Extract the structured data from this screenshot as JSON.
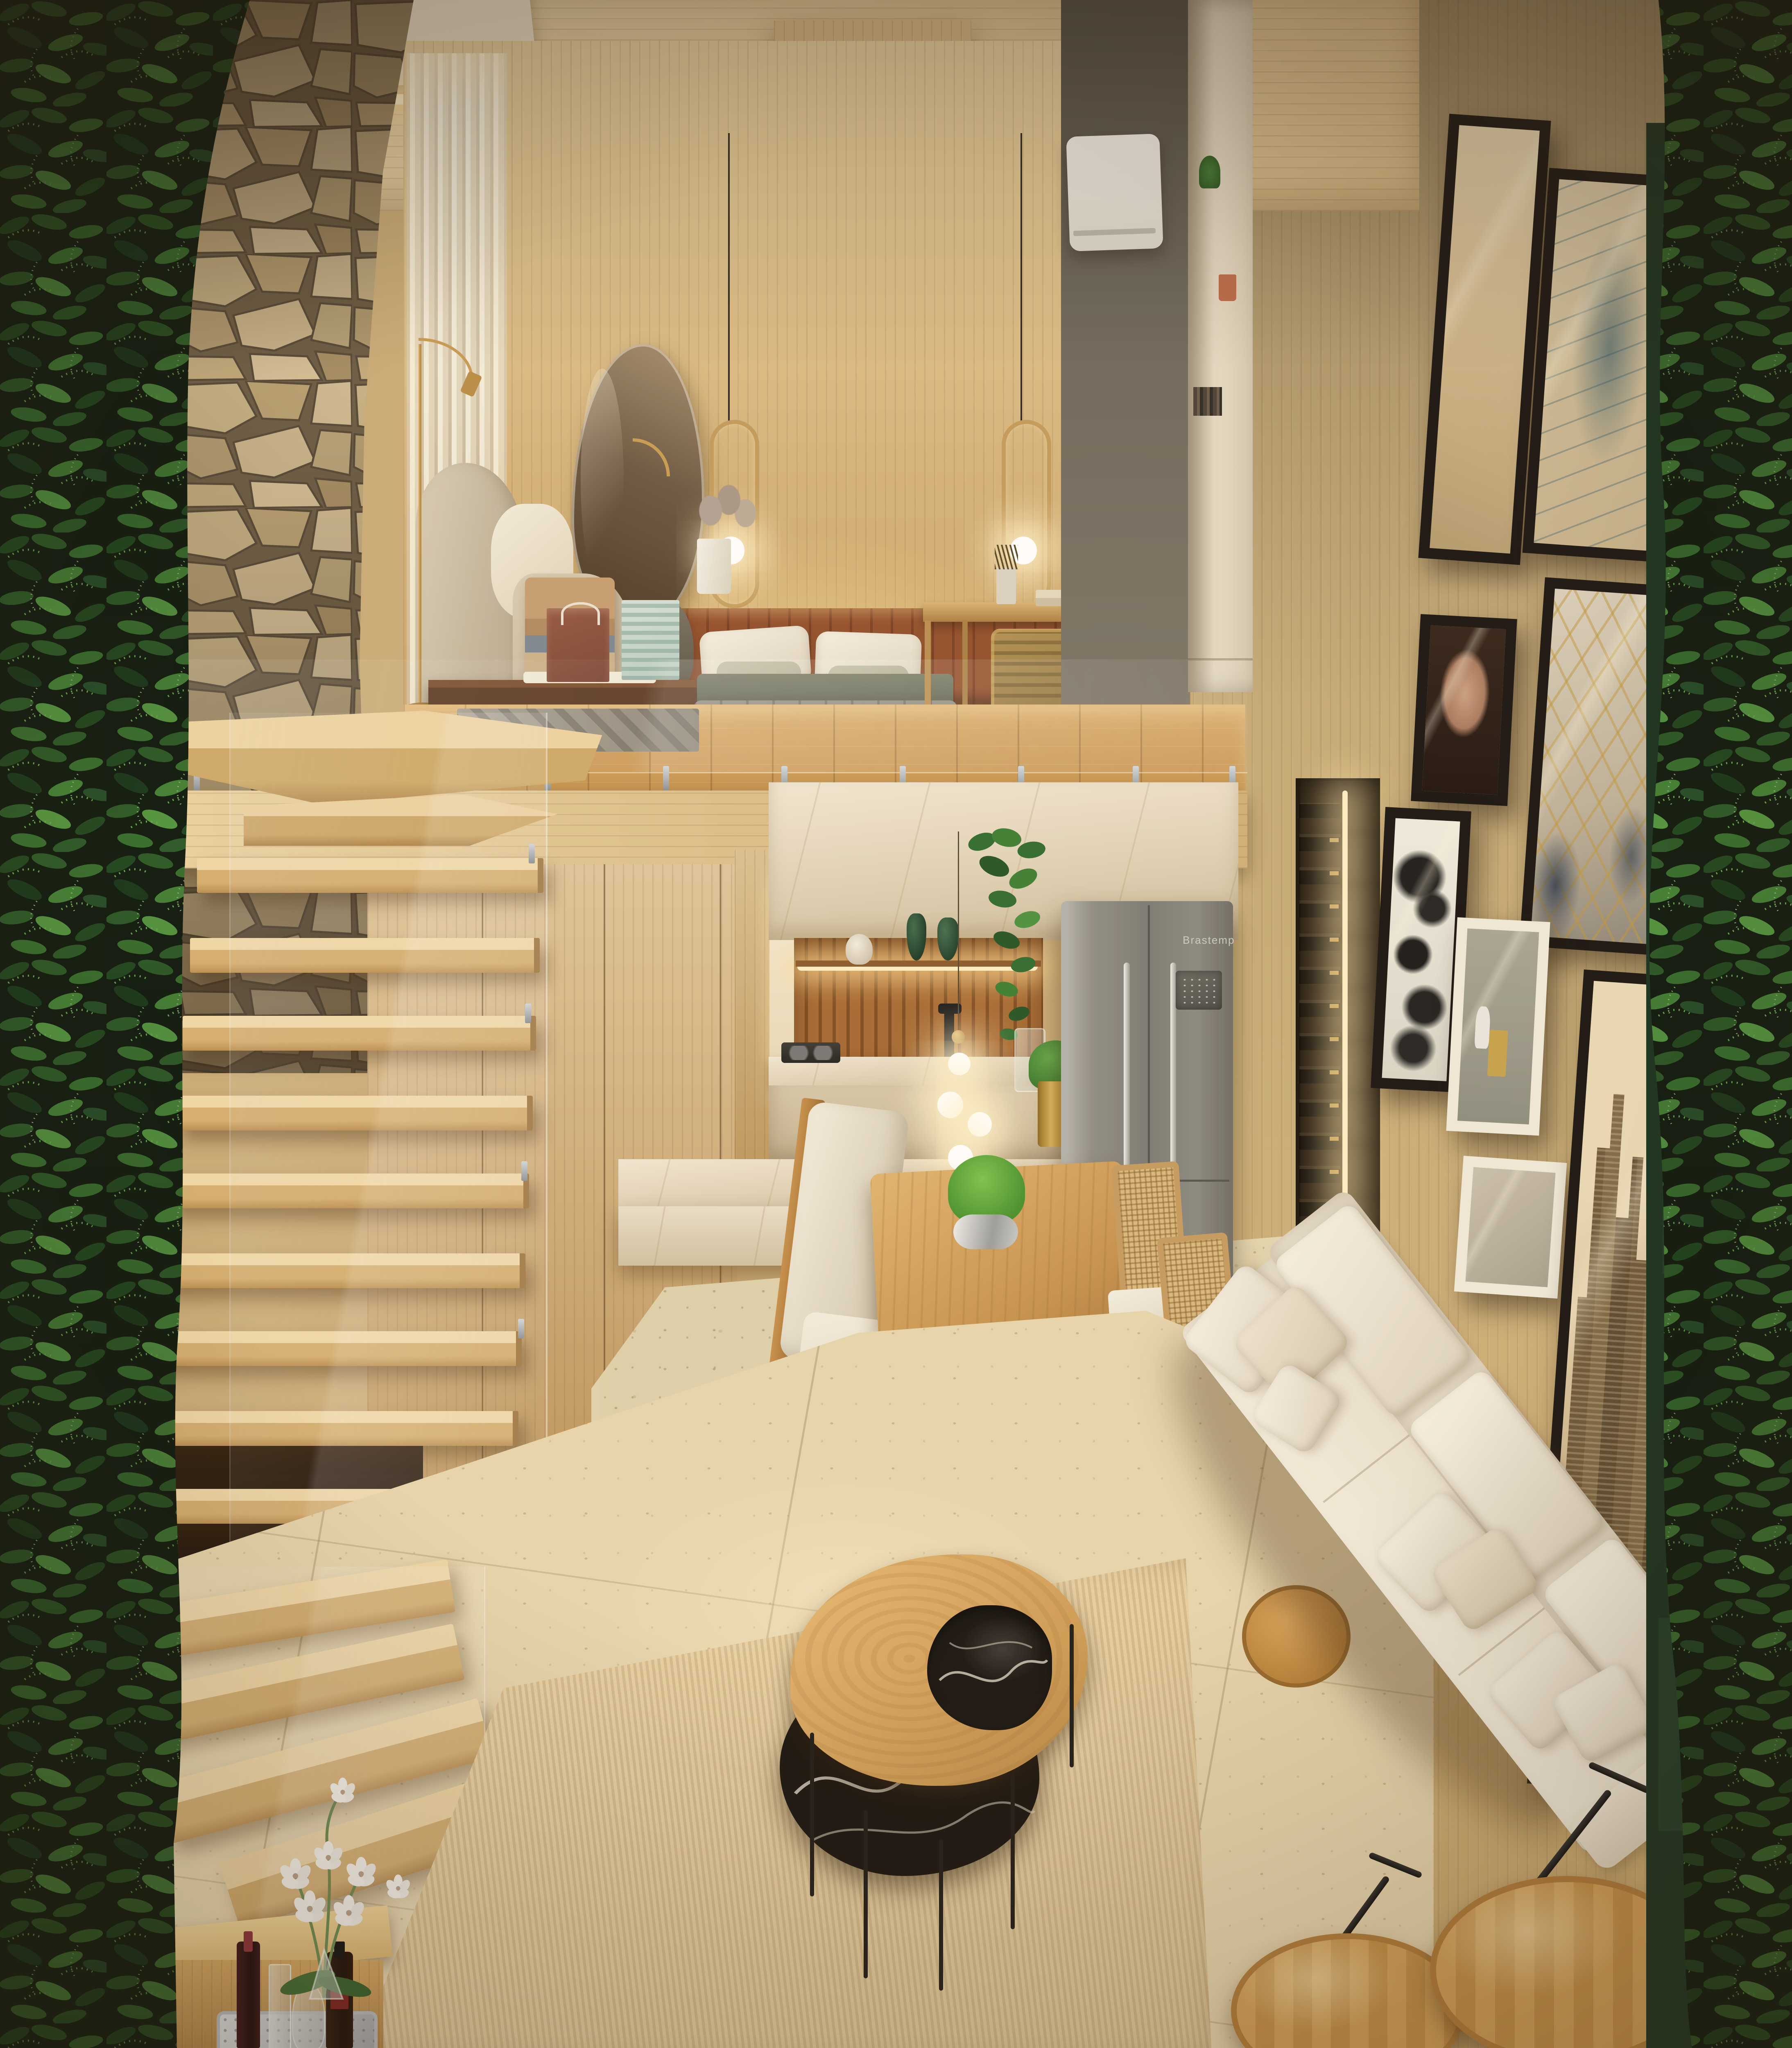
{
  "scene": {
    "type": "3d-interior-render",
    "title": "Compact loft apartment with mezzanine bedroom over kitchen and living room",
    "areas": [
      "mezzanine bedroom and home office",
      "floating oak staircase with glass guard",
      "kitchen with marble counters and dining nook",
      "living room with gallery wall",
      "vertical gardens on both side walls"
    ],
    "lighting": "warm evening artificial lighting with cove LEDs, pendants and recessed spots"
  },
  "labels": {
    "fridge_brand": "Brastemp"
  },
  "palette": {
    "oak_light": "#e3cb9c",
    "oak_mid": "#c9a263",
    "oak_dark": "#a5773f",
    "stone_beige": "#c7b183",
    "leather_rust": "#8a4a2c",
    "marble_cream": "#ece2cc",
    "steel_grey": "#8f8d86",
    "sofa_cream": "#efe8da",
    "plant_green": "#3c7a33",
    "planter_green_dark": "#16301d",
    "black_marble": "#16120e",
    "glow_warm": "#ffe2a8"
  },
  "objects": [
    {
      "name": "vertical-garden-left",
      "note": "ferns and prayer plants full height"
    },
    {
      "name": "vertical-garden-right",
      "note": "calathea and ferns with dark green planters"
    },
    {
      "name": "stone-feature-wall",
      "note": "stacked beige quarry stone"
    },
    {
      "name": "floating-staircase",
      "note": "cantilevered oak treads with glass balustrade"
    },
    {
      "name": "mezzanine-bed",
      "note": "grey quilted duvet, white and sage pillows"
    },
    {
      "name": "leather-headboard",
      "note": "rust channel-tufted panel with cove light"
    },
    {
      "name": "wall-mirror",
      "note": "organic pebble shaped mirror"
    },
    {
      "name": "pendant-lights",
      "note": "two brass oval rings with glowing globes"
    },
    {
      "name": "armchair",
      "note": "beige wingback with striped fringe throw"
    },
    {
      "name": "floor-lamp",
      "note": "brass arc reading lamp"
    },
    {
      "name": "vanity-desk",
      "note": "dark wood with gift bag, patterned box and mug"
    },
    {
      "name": "office-desk",
      "note": "brass frame desk with tan ribbed office chair"
    },
    {
      "name": "task-lamp",
      "note": "black counterweight desk lamp"
    },
    {
      "name": "laptop",
      "note": "white laptop on desk"
    },
    {
      "name": "bookshelf",
      "note": "white open shelving"
    },
    {
      "name": "air-conditioner",
      "note": "white split unit"
    },
    {
      "name": "kitchen-niche",
      "note": "wood slat back wall with lit shelf, green glass vases and shell"
    },
    {
      "name": "hanging-plant",
      "note": "trailing pothos from mezzanine edge"
    },
    {
      "name": "kitchen-counter",
      "note": "cream quartzite counters and island"
    },
    {
      "name": "gas-cooktop",
      "note": "dark two-burner hob"
    },
    {
      "name": "black-faucet",
      "note": "matte black tall mixer"
    },
    {
      "name": "pendant-globes",
      "note": "cluster of four glowing glass orbs"
    },
    {
      "name": "brass-planter",
      "note": "gold pot with green plant"
    },
    {
      "name": "refrigerator",
      "note": "stainless french-door fridge"
    },
    {
      "name": "wine-rack",
      "note": "wall column of horizontal bottles with LED strip"
    },
    {
      "name": "dining-nook",
      "note": "white banquette, pedestal live-edge table, cane chairs, fern centerpiece"
    },
    {
      "name": "gallery-wall",
      "note": "black and white framed art: abstract, blue feather, portrait, gold geometric, butterfly, still life, sepia city"
    },
    {
      "name": "cream-sofa",
      "note": "long cream sofa with many pillows along right wall"
    },
    {
      "name": "coffee-tables",
      "note": "organic oak top nesting over black marble table"
    },
    {
      "name": "area-rug",
      "note": "ribbed beige rug on travertine floor"
    },
    {
      "name": "round-side-tables",
      "note": "two oak tables with black metal arms"
    },
    {
      "name": "drinks-console",
      "note": "bar tray with wine bottles and white orchid arrangement"
    },
    {
      "name": "wood-ceiling",
      "note": "oak ceiling with recessed spotlights and hood volume"
    }
  ]
}
